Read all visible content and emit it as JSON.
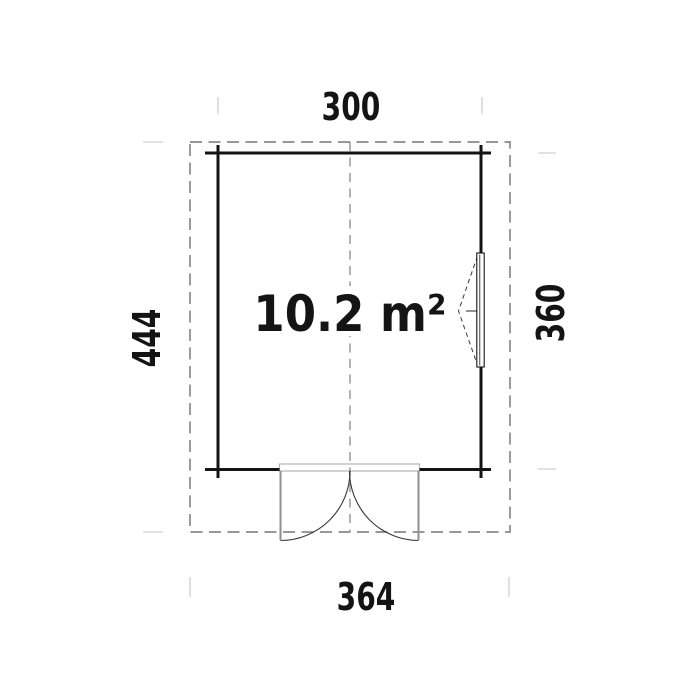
{
  "plan": {
    "area_label": "10.2 m²",
    "dimensions": {
      "top": "300",
      "left": "444",
      "right": "360",
      "bottom": "364"
    },
    "colors": {
      "background": "#ffffff",
      "line": "#141414",
      "dashed": "#8a8a8a",
      "tick": "#d9d9d9",
      "door_frame": "#b5b5b5",
      "door_panel": "#8f8f8f",
      "swing": "#3a3a3a",
      "text": "#141414"
    }
  }
}
